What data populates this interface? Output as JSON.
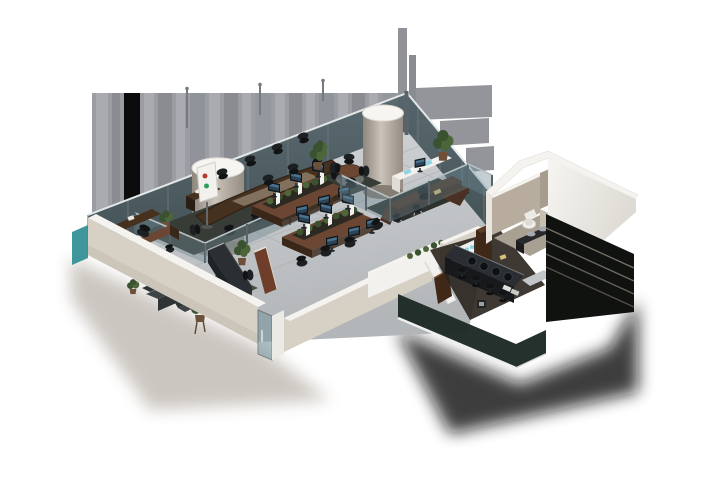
{
  "meta": {
    "title": "3D Office Floor Plan Render",
    "description": "Isometric cutaway 3D rendering of a modern office interior viewed from above on a white background"
  },
  "colors": {
    "bg": "#ffffff",
    "band_base": "#97989e",
    "band_light": "#a6a7ad",
    "band_dark": "#85868d",
    "band_mid": "#9193999",
    "panel_gray": "#8e9095",
    "post": "#6f727a",
    "glass": "#44545a",
    "glass_dark": "#3a4a50",
    "glass_edge": "#e2e8e8",
    "mullion": "#69747a",
    "glasspart": "#6c8890",
    "part_rail": "#b7c1c4",
    "part_post": "#59646a",
    "floor_light": "#d0d3d5",
    "floor_dark": "#b0b3b6",
    "tile": "#a6a9ac",
    "cream": "#d7d0c4",
    "cream_dark": "#c2bab0",
    "wallcap": "#f5f3ef",
    "cyl_left": "#8f867c",
    "cyl_mid": "#cac3b9",
    "cyl_right": "#9a9187",
    "cyl_top": "#f6f5f2",
    "carpet": "#383c37",
    "exec_rug": "#2e312c",
    "rug_green": "#4a5040",
    "wood_dark": "#46311f",
    "wood_mid": "#6b4632",
    "wood_light": "#8d7e68",
    "wood_red": "#6e3e2a",
    "desk_front": "#3a2719",
    "walnut": "#3f2817",
    "walnut_light": "#5d3d26",
    "chair": "#1d2022",
    "chair_back": "#111315",
    "chrome": "#b9bdbf",
    "sofa": "#3e4446",
    "sofa_dark": "#2f3537",
    "recep": "#2b2f33",
    "recep_side": "#1f2326",
    "recep_wood": "#6f4130",
    "screen": "#2c4255",
    "screen_hi": "#4a718e",
    "monitor_frame": "#10171c",
    "plant": "#4d6639",
    "plant_dark": "#3a5230",
    "pot": "#6e4f38",
    "white_box": "#f2f1ed",
    "white_shade": "#e0ddd6",
    "white_struct": "#f4f3ef",
    "taupe": "#b7ac9d",
    "taupe_dark": "#a79d8e",
    "taupe_floor": "#a8a193",
    "bar_top": "#2a2d31",
    "bar_front": "#17191c",
    "steel": "#a4abaf",
    "mug": "#8fd2e2",
    "teal_fin": "#2b8c90",
    "band_glass": "#1e2a25",
    "band_edge": "#eef0ee",
    "facade": "#101210",
    "rail": "#8a8378",
    "shadow_warm": "#8d8276",
    "shadow_dark": "#0d0b08"
  },
  "scene": {
    "architecture": {
      "curtain_wall": "Full-height tinted glass curtain wall with mullions along the back facades",
      "columns": [
        "round structural column left",
        "round structural column right"
      ],
      "entrance": "Glass entrance door set in the angled cream front wall",
      "service_block": "Angular white service volume housing the restroom",
      "facade": "Dark stacked facade slabs at the lower right"
    },
    "rooms": [
      {
        "name": "Conference room",
        "furniture": [
          "boat-shaped conference table",
          "task chairs",
          "presentation board on stand",
          "low glass partition",
          "potted plants",
          "side cabinet with phone"
        ]
      },
      {
        "name": "Open workspace",
        "furniture": [
          "two back-to-back desk islands",
          "monitors",
          "privacy screens",
          "green hedge planters",
          "task chairs"
        ]
      },
      {
        "name": "Executive office",
        "furniture": [
          "U-shaped desk",
          "executive chair",
          "guest chairs",
          "white credenza with monitor",
          "dark area rug",
          "glass partitions",
          "tall plant"
        ]
      },
      {
        "name": "Meeting corner",
        "furniture": [
          "round wood table",
          "four chairs",
          "corner plant"
        ]
      },
      {
        "name": "Manager office",
        "furniture": [
          "L-shaped desk",
          "executive chair",
          "guest chairs",
          "credenza",
          "plants"
        ]
      },
      {
        "name": "Reception lounge",
        "furniture": [
          "reception counter with timber strip",
          "wood divider panel",
          "sofa",
          "armchair",
          "coffee table",
          "green rug",
          "plant on stand",
          "tall plant"
        ]
      },
      {
        "name": "Kitchen bar",
        "furniture": [
          "bar counter",
          "four stools",
          "open shelf with blue mugs",
          "tall cabinet",
          "espresso machine",
          "wood doors",
          "floor mat"
        ]
      },
      {
        "name": "Restroom",
        "furniture": [
          "toilet",
          "double-sink vanity",
          "wood door"
        ]
      }
    ]
  }
}
